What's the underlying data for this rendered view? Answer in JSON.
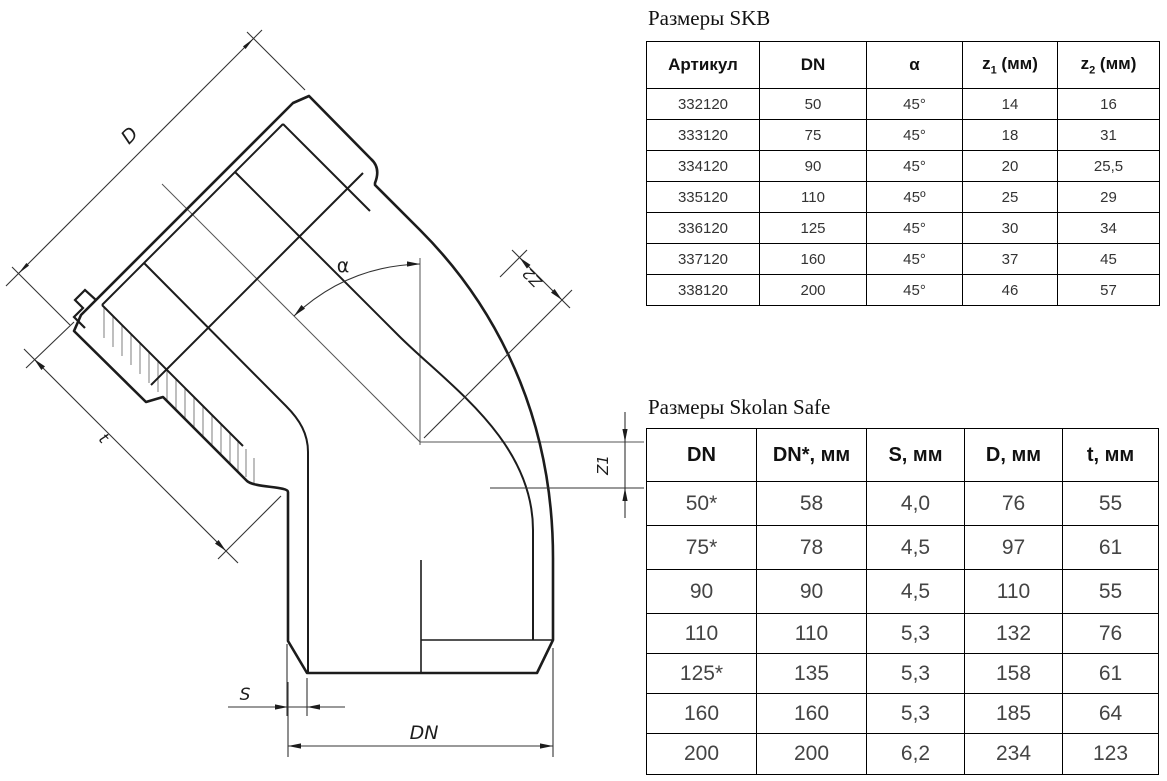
{
  "drawing": {
    "dim_labels": {
      "d": "D",
      "t": "t",
      "alpha": "α",
      "z2": "Z2",
      "z1": "Z1",
      "s": "S",
      "dn": "DN"
    }
  },
  "table_skb": {
    "title": "Размеры SKB",
    "headers": {
      "col1": "Артикул",
      "col2": "DN",
      "col3": "α",
      "z1_base": "z",
      "z1_sub": "1",
      "z1_unit": " (мм)",
      "z2_base": "z",
      "z2_sub": "2",
      "z2_unit": " (мм)"
    },
    "rows": [
      [
        "332120",
        "50",
        "45°",
        "14",
        "16"
      ],
      [
        "333120",
        "75",
        "45°",
        "18",
        "31"
      ],
      [
        "334120",
        "90",
        "45°",
        "20",
        "25,5"
      ],
      [
        "335120",
        "110",
        "45º",
        "25",
        "29"
      ],
      [
        "336120",
        "125",
        "45°",
        "30",
        "34"
      ],
      [
        "337120",
        "160",
        "45°",
        "37",
        "45"
      ],
      [
        "338120",
        "200",
        "45°",
        "46",
        "57"
      ]
    ]
  },
  "table_skolan": {
    "title": "Размеры Skolan Safe",
    "headers": [
      "DN",
      "DN*, мм",
      "S, мм",
      "D, мм",
      "t, мм"
    ],
    "rows": [
      [
        "50*",
        "58",
        "4,0",
        "76",
        "55"
      ],
      [
        "75*",
        "78",
        "4,5",
        "97",
        "61"
      ],
      [
        "90",
        "90",
        "4,5",
        "110",
        "55"
      ],
      [
        "110",
        "110",
        "5,3",
        "132",
        "76"
      ],
      [
        "125*",
        "135",
        "5,3",
        "158",
        "61"
      ],
      [
        "160",
        "160",
        "5,3",
        "185",
        "64"
      ],
      [
        "200",
        "200",
        "6,2",
        "234",
        "123"
      ]
    ]
  }
}
